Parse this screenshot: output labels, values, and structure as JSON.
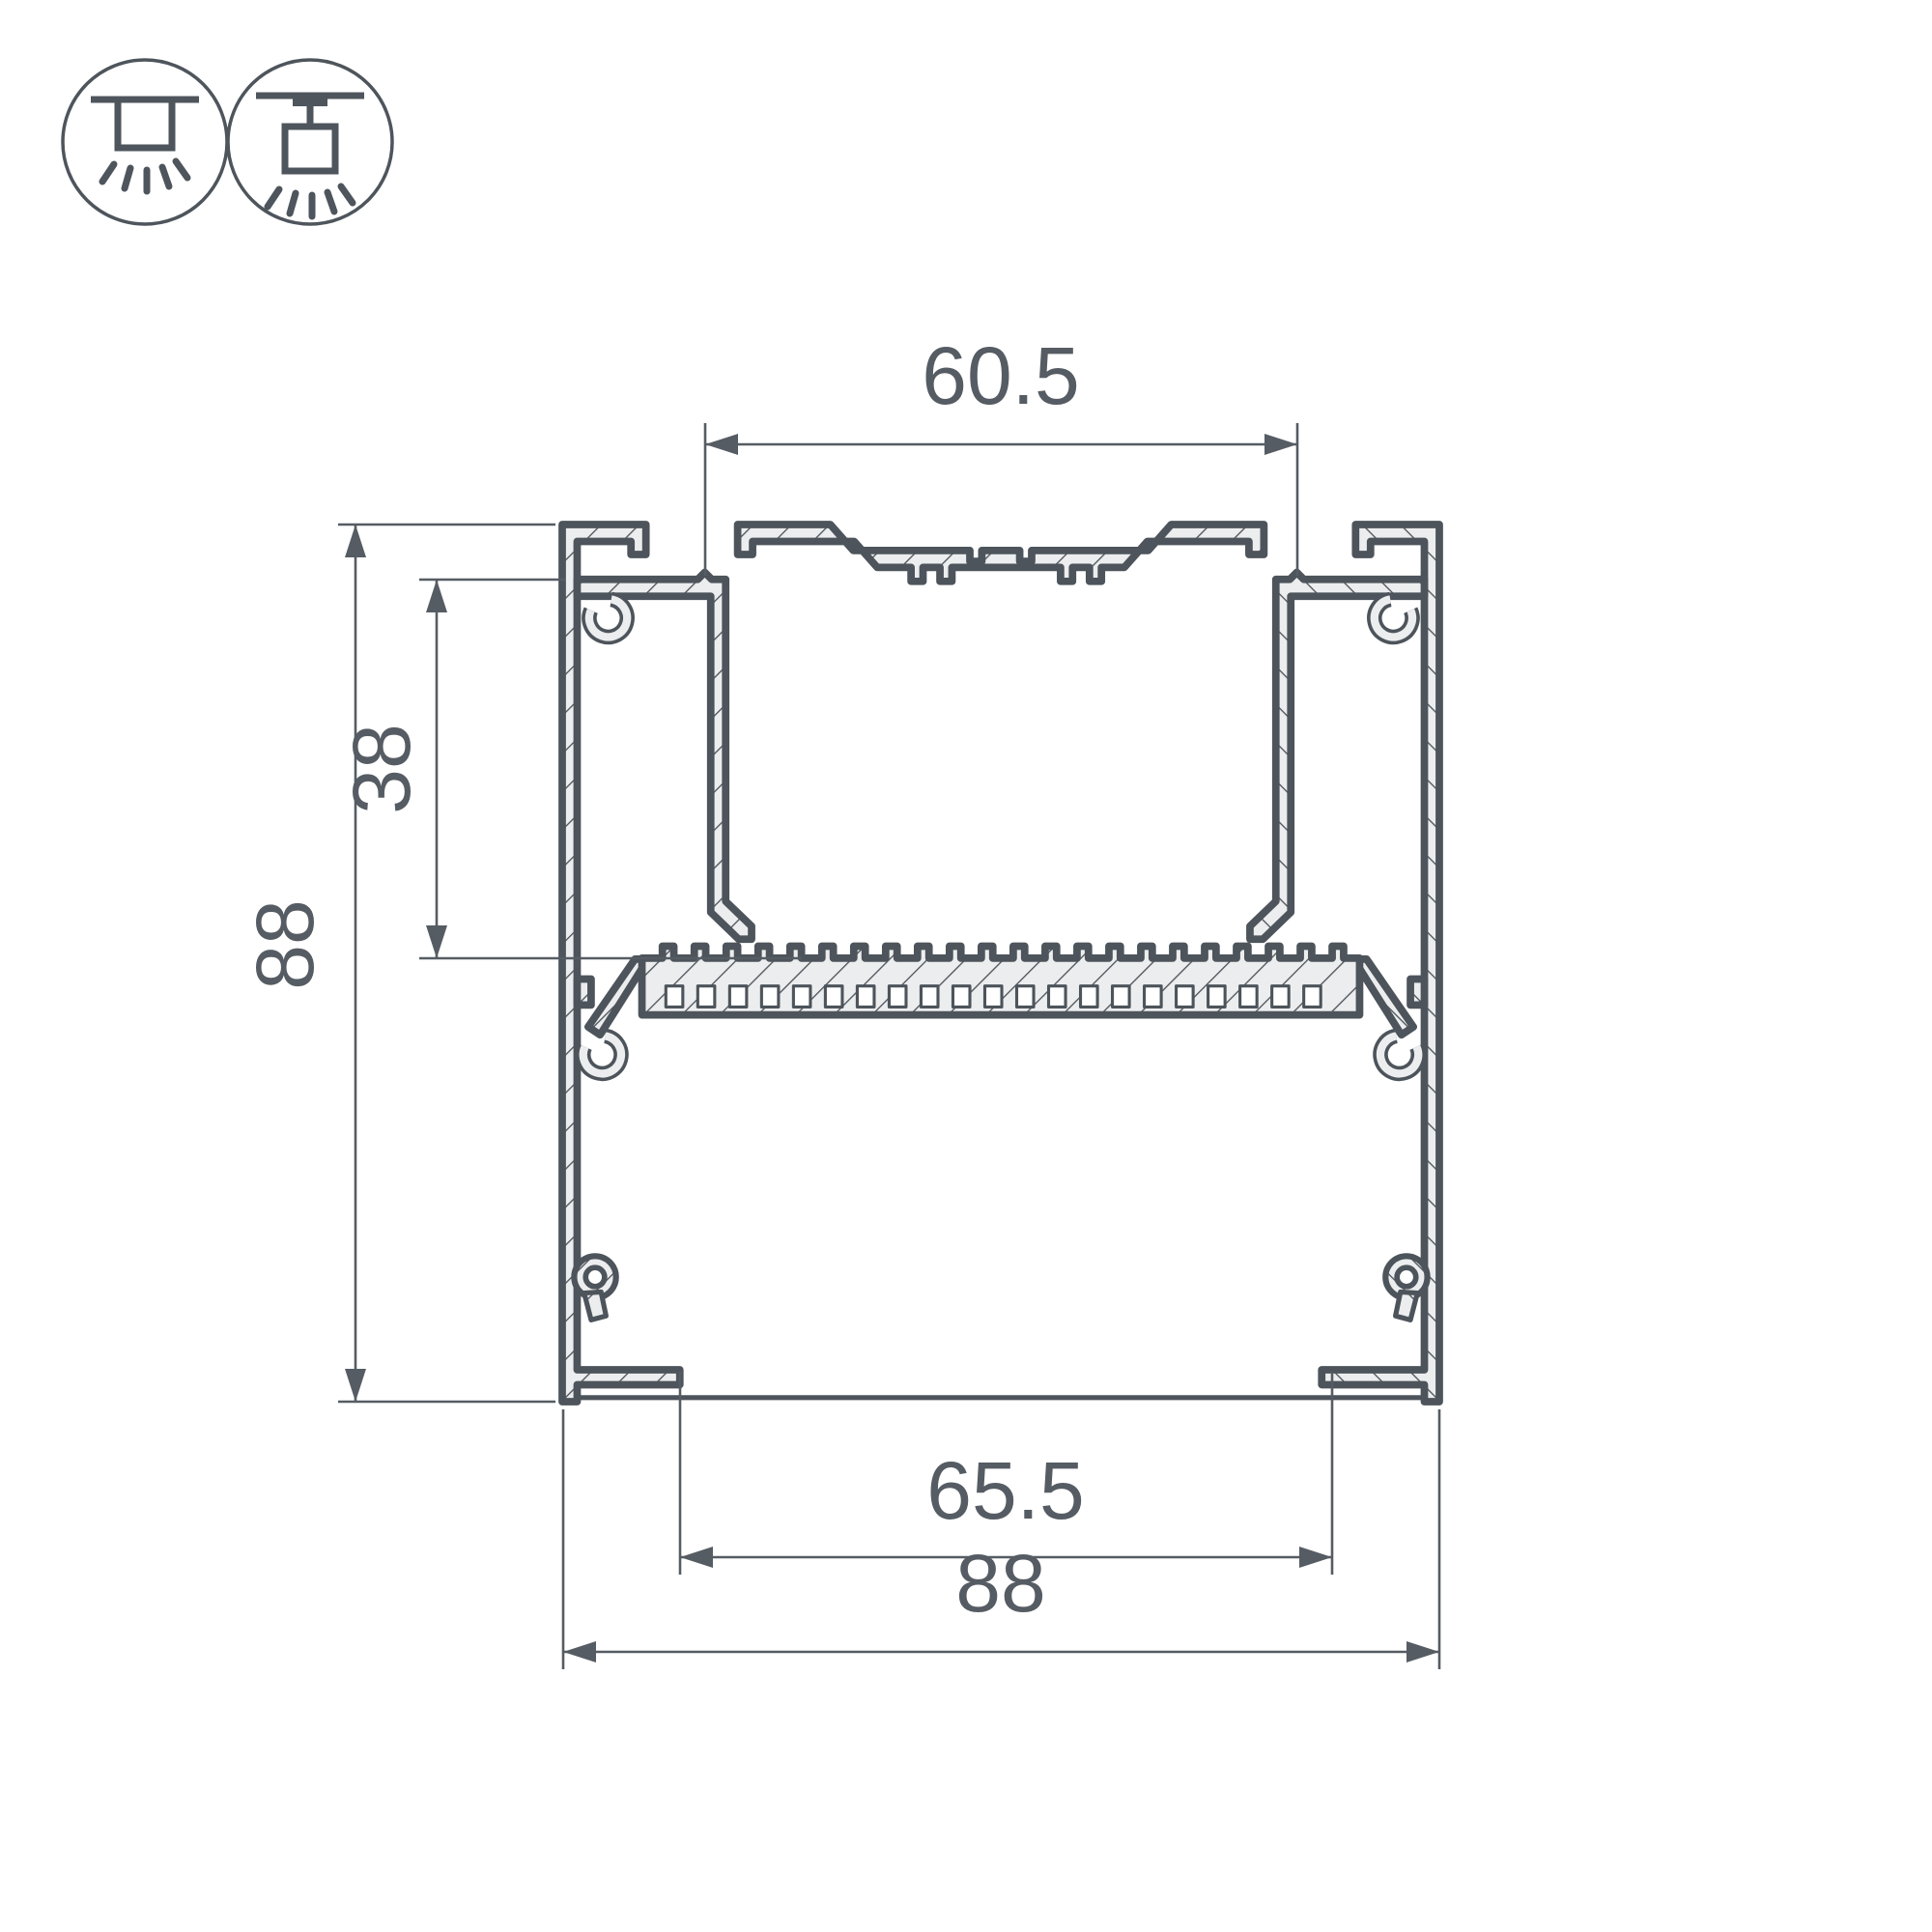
{
  "drawing": {
    "title": "led-profile-cross-section",
    "dimensions": {
      "top_width": "60.5",
      "inner_height": "38",
      "overall_height": "88",
      "bottom_opening": "65.5",
      "overall_width": "88"
    },
    "icons": [
      {
        "name": "surface-mount-icon",
        "meaning": "surface ceiling mounted luminaire"
      },
      {
        "name": "pendant-mount-icon",
        "meaning": "pendant suspended luminaire"
      }
    ],
    "colors": {
      "line": "#4d545b",
      "thin_line": "#565c63",
      "material_fill": "#ecedee",
      "background": "#ffffff"
    }
  }
}
